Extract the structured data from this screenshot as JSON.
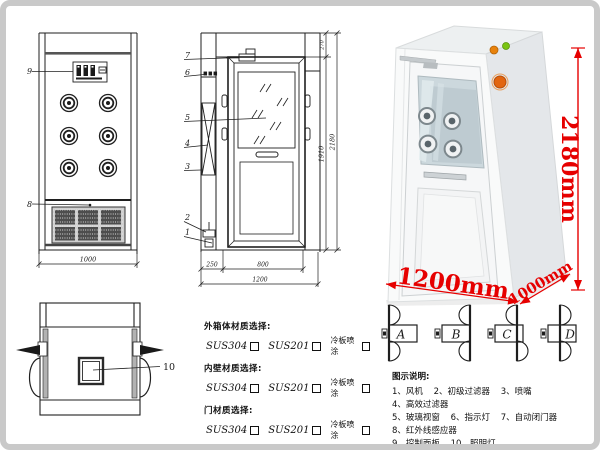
{
  "drawing": {
    "front_view": {
      "label_9": "9",
      "label_8": "8",
      "dim_width": "1000"
    },
    "side_view": {
      "labels": [
        "7",
        "6",
        "5",
        "4",
        "3",
        "2",
        "1"
      ],
      "dim_250": "250",
      "dim_800": "800",
      "dim_1200": "1200",
      "dim_1910": "1910",
      "dim_2180": "2180",
      "dim_270": "270"
    },
    "top_view": {
      "label_10": "10"
    }
  },
  "photo": {
    "height_label": "2180mm",
    "width_label": "1200mm",
    "depth_label": "1000mm",
    "accent_color": "#e60000"
  },
  "materials": {
    "groups": [
      {
        "title": "外箱体材质选择:",
        "options": [
          "SUS304",
          "SUS201",
          "冷板喷涂"
        ]
      },
      {
        "title": "内壁材质选择:",
        "options": [
          "SUS304",
          "SUS201",
          "冷板喷涂"
        ]
      },
      {
        "title": "门材质选择:",
        "options": [
          "SUS304",
          "SUS201",
          "冷板喷涂"
        ]
      }
    ]
  },
  "door_types": {
    "letters": [
      "A",
      "B",
      "C",
      "D"
    ]
  },
  "legend": {
    "title": "图示说明:",
    "rows": [
      [
        "1、风机",
        "2、初级过滤器",
        "3、喷嘴",
        "4、高效过滤器"
      ],
      [
        "5、玻璃视窗",
        "6、指示灯",
        "7、自动闭门器",
        "8、红外线感应器"
      ],
      [
        "9、控制面板",
        "10、照明灯"
      ]
    ]
  }
}
